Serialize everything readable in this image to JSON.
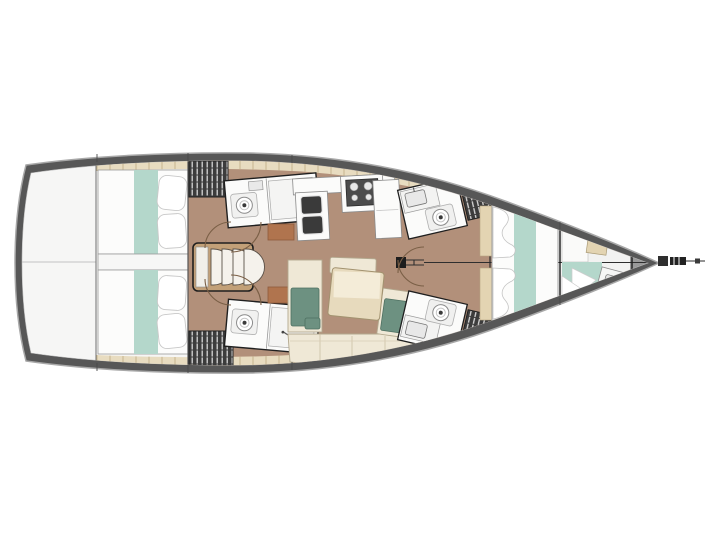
{
  "figure": {
    "kind": "sailing-yacht-interior-layout-plan",
    "view": "top-down",
    "bow_direction": "right",
    "background": "#ffffff"
  },
  "palette": {
    "hull_band": "#575757",
    "hull_outline": "#a8a8a8",
    "deck_white": "#f6f6f5",
    "floor_brown": "#b2907a",
    "deck_tile": "#e8dcc0",
    "tile_line": "#c6b48e",
    "shelf_beige": "#e3d4b2",
    "bedding_white": "#fcfcfb",
    "bedding_teal": "#b4d7cb",
    "sofa_cream": "#efe8d6",
    "cushion_green": "#6d9181",
    "table_beige": "#e7dabd",
    "table_highlight": "#f4ecd8",
    "wood_cabinet": "#b0744e",
    "stairs_wood": "#c2a078",
    "counter_white": "#fbfbfa",
    "fixture_dark": "#3a3a3a",
    "locker_dark": "#3c3c3c",
    "locker_stripe": "#d8d8d8",
    "outline_dark": "#1f1f1f",
    "door_arc": "#7a5f46",
    "rig_line": "#2e2e2e",
    "bow_gray": "#999999"
  },
  "features": [
    "hull",
    "stern-deck",
    "aft-cabin-port-berth",
    "aft-cabin-starboard-berth",
    "engine-compartment",
    "companionway-stairs",
    "aft-head-port",
    "aft-head-starboard",
    "wet-locker-port",
    "wet-locker-starboard",
    "galley",
    "galley-stove",
    "galley-double-sink",
    "galley-fridge",
    "salon-sofa",
    "salon-table",
    "seat-cushions",
    "mast-step",
    "rig-centerline",
    "forward-head-port",
    "forward-head-starboard",
    "hanging-locker-port",
    "hanging-locker-starboard",
    "owner-cabin-berth",
    "forepeak-berth",
    "forepeak-sink",
    "anchor-locker",
    "bowsprit"
  ]
}
